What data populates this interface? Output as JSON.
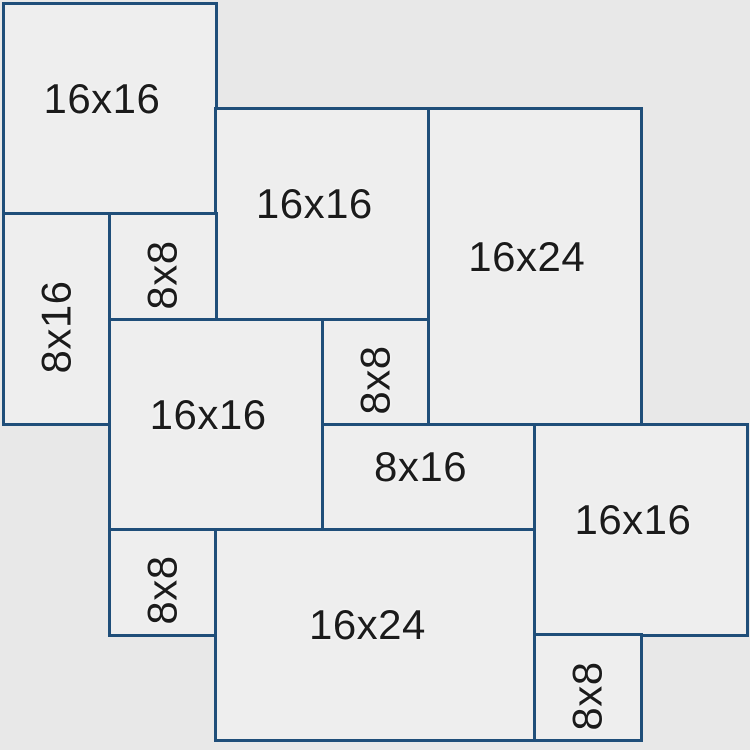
{
  "diagram": {
    "kind": "paver-laying-pattern",
    "grid_units_wide": 7,
    "grid_units_high": 7,
    "unit_inches": 8,
    "colors": {
      "background": "#e8e8e8",
      "tile_fill": "#eeeeee",
      "border": "#1f4e79",
      "label": "#1b1b1b"
    },
    "tiles": [
      {
        "label": "16x16",
        "col": 0,
        "row": 0,
        "w": 2,
        "h": 2,
        "orientation": "horizontal"
      },
      {
        "label": "16x16",
        "col": 2,
        "row": 1,
        "w": 2,
        "h": 2,
        "orientation": "horizontal"
      },
      {
        "label": "16x24",
        "col": 4,
        "row": 1,
        "w": 2,
        "h": 3,
        "orientation": "horizontal"
      },
      {
        "label": "8x16",
        "col": 0,
        "row": 2,
        "w": 1,
        "h": 2,
        "orientation": "vertical"
      },
      {
        "label": "8x8",
        "col": 1,
        "row": 2,
        "w": 1,
        "h": 1,
        "orientation": "vertical"
      },
      {
        "label": "16x16",
        "col": 1,
        "row": 3,
        "w": 2,
        "h": 2,
        "orientation": "horizontal"
      },
      {
        "label": "8x8",
        "col": 3,
        "row": 3,
        "w": 1,
        "h": 1,
        "orientation": "vertical"
      },
      {
        "label": "8x16",
        "col": 3,
        "row": 4,
        "w": 2,
        "h": 1,
        "orientation": "horizontal"
      },
      {
        "label": "16x16",
        "col": 5,
        "row": 4,
        "w": 2,
        "h": 2,
        "orientation": "horizontal"
      },
      {
        "label": "8x8",
        "col": 1,
        "row": 5,
        "w": 1,
        "h": 1,
        "orientation": "vertical"
      },
      {
        "label": "16x24",
        "col": 2,
        "row": 5,
        "w": 3,
        "h": 2,
        "orientation": "horizontal"
      },
      {
        "label": "8x8",
        "col": 5,
        "row": 6,
        "w": 1,
        "h": 1,
        "orientation": "vertical"
      }
    ]
  }
}
